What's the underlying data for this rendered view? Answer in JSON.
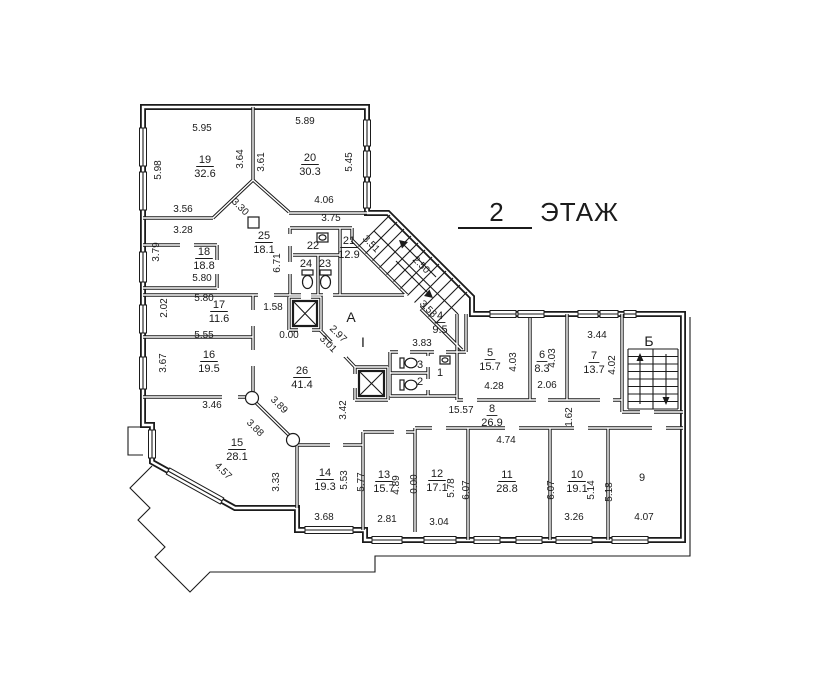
{
  "title": {
    "floor_number": "2",
    "floor_word": "ЭТАЖ"
  },
  "plan": {
    "rooms": [
      {
        "n": "19",
        "a": "32.6",
        "x": 205,
        "y": 166
      },
      {
        "n": "20",
        "a": "30.3",
        "x": 310,
        "y": 164
      },
      {
        "n": "25",
        "a": "18.1",
        "x": 264,
        "y": 242
      },
      {
        "n": "18",
        "a": "18.8",
        "x": 204,
        "y": 258
      },
      {
        "n": "17",
        "a": "11.6",
        "x": 219,
        "y": 311
      },
      {
        "n": "16",
        "a": "19.5",
        "x": 209,
        "y": 361
      },
      {
        "n": "15",
        "a": "28.1",
        "x": 237,
        "y": 449
      },
      {
        "n": "26",
        "a": "41.4",
        "x": 302,
        "y": 377
      },
      {
        "n": "21",
        "a": "12.9",
        "x": 349,
        "y": 247
      },
      {
        "n": "22",
        "a": "",
        "x": 313,
        "y": 245
      },
      {
        "n": "24",
        "a": "",
        "x": 306,
        "y": 263
      },
      {
        "n": "23",
        "a": "",
        "x": 325,
        "y": 263
      },
      {
        "n": "4",
        "a": "9.5",
        "x": 440,
        "y": 322
      },
      {
        "n": "3",
        "a": "",
        "x": 420,
        "y": 364
      },
      {
        "n": "2",
        "a": "",
        "x": 420,
        "y": 381
      },
      {
        "n": "1",
        "a": "",
        "x": 440,
        "y": 372
      },
      {
        "n": "5",
        "a": "15.7",
        "x": 490,
        "y": 359
      },
      {
        "n": "6",
        "a": "8.3",
        "x": 542,
        "y": 361
      },
      {
        "n": "7",
        "a": "13.7",
        "x": 594,
        "y": 362
      },
      {
        "n": "8",
        "a": "26.9",
        "x": 492,
        "y": 415
      },
      {
        "n": "9",
        "a": "",
        "x": 642,
        "y": 477
      },
      {
        "n": "10",
        "a": "19.1",
        "x": 577,
        "y": 481
      },
      {
        "n": "11",
        "a": "28.8",
        "x": 507,
        "y": 481
      },
      {
        "n": "12",
        "a": "17.1",
        "x": 437,
        "y": 480
      },
      {
        "n": "13",
        "a": "15.7",
        "x": 384,
        "y": 481
      },
      {
        "n": "14",
        "a": "19.3",
        "x": 325,
        "y": 479
      }
    ],
    "dims": [
      {
        "t": "5.95",
        "x": 202,
        "y": 131,
        "r": 0
      },
      {
        "t": "5.98",
        "x": 161,
        "y": 170,
        "r": -90
      },
      {
        "t": "3.64",
        "x": 243,
        "y": 159,
        "r": -90
      },
      {
        "t": "3.61",
        "x": 264,
        "y": 162,
        "r": -90
      },
      {
        "t": "5.89",
        "x": 305,
        "y": 124,
        "r": 0
      },
      {
        "t": "5.45",
        "x": 352,
        "y": 162,
        "r": -90
      },
      {
        "t": "4.06",
        "x": 324,
        "y": 203,
        "r": 0
      },
      {
        "t": "3.75",
        "x": 331,
        "y": 221,
        "r": 0
      },
      {
        "t": "3.56",
        "x": 183,
        "y": 212,
        "r": 0
      },
      {
        "t": "3.28",
        "x": 183,
        "y": 233,
        "r": 0
      },
      {
        "t": "3.30",
        "x": 238,
        "y": 209,
        "r": 45
      },
      {
        "t": "3.79",
        "x": 159,
        "y": 252,
        "r": -90
      },
      {
        "t": "5.80",
        "x": 202,
        "y": 281,
        "r": 0
      },
      {
        "t": "5.80",
        "x": 204,
        "y": 301,
        "r": 0
      },
      {
        "t": "2.02",
        "x": 167,
        "y": 308,
        "r": -90
      },
      {
        "t": "1.58",
        "x": 273,
        "y": 310,
        "r": 0
      },
      {
        "t": "0.00",
        "x": 289,
        "y": 338,
        "r": 0
      },
      {
        "t": "5.55",
        "x": 204,
        "y": 338,
        "r": 0
      },
      {
        "t": "3.67",
        "x": 166,
        "y": 363,
        "r": -90
      },
      {
        "t": "2.97",
        "x": 336,
        "y": 336,
        "r": 45
      },
      {
        "t": "3.01",
        "x": 326,
        "y": 346,
        "r": 45
      },
      {
        "t": "2.50",
        "x": 419,
        "y": 267,
        "r": 45
      },
      {
        "t": "3.58",
        "x": 426,
        "y": 311,
        "r": 45
      },
      {
        "t": "3.51",
        "x": 369,
        "y": 246,
        "r": 45
      },
      {
        "t": "6.71",
        "x": 280,
        "y": 263,
        "r": -90
      },
      {
        "t": "4.28",
        "x": 494,
        "y": 389,
        "r": 0
      },
      {
        "t": "4.03",
        "x": 516,
        "y": 362,
        "r": -90
      },
      {
        "t": "2.06",
        "x": 547,
        "y": 388,
        "r": 0
      },
      {
        "t": "4.03",
        "x": 555,
        "y": 358,
        "r": -90
      },
      {
        "t": "3.44",
        "x": 597,
        "y": 338,
        "r": 0
      },
      {
        "t": "4.02",
        "x": 615,
        "y": 365,
        "r": -90
      },
      {
        "t": "15.57",
        "x": 461,
        "y": 413,
        "r": 0
      },
      {
        "t": "1.62",
        "x": 572,
        "y": 417,
        "r": -90
      },
      {
        "t": "3.42",
        "x": 346,
        "y": 410,
        "r": -90
      },
      {
        "t": "3.46",
        "x": 212,
        "y": 408,
        "r": 0
      },
      {
        "t": "3.89",
        "x": 277,
        "y": 407,
        "r": 45
      },
      {
        "t": "3.88",
        "x": 253,
        "y": 430,
        "r": 45
      },
      {
        "t": "4.57",
        "x": 221,
        "y": 473,
        "r": 45
      },
      {
        "t": "3.33",
        "x": 279,
        "y": 482,
        "r": -90
      },
      {
        "t": "3.83",
        "x": 422,
        "y": 346,
        "r": 0
      },
      {
        "t": "5.53",
        "x": 347,
        "y": 480,
        "r": -90
      },
      {
        "t": "3.68",
        "x": 324,
        "y": 520,
        "r": 0
      },
      {
        "t": "5.77",
        "x": 364,
        "y": 482,
        "r": -90
      },
      {
        "t": "4.89",
        "x": 399,
        "y": 485,
        "r": -90
      },
      {
        "t": "2.81",
        "x": 387,
        "y": 522,
        "r": 0
      },
      {
        "t": "0.00",
        "x": 417,
        "y": 484,
        "r": -90
      },
      {
        "t": "5.78",
        "x": 454,
        "y": 488,
        "r": -90
      },
      {
        "t": "3.04",
        "x": 439,
        "y": 525,
        "r": 0
      },
      {
        "t": "6.07",
        "x": 469,
        "y": 490,
        "r": -90
      },
      {
        "t": "4.74",
        "x": 506,
        "y": 443,
        "r": 0
      },
      {
        "t": "6.07",
        "x": 554,
        "y": 490,
        "r": -90
      },
      {
        "t": "5.14",
        "x": 594,
        "y": 490,
        "r": -90
      },
      {
        "t": "3.26",
        "x": 574,
        "y": 520,
        "r": 0
      },
      {
        "t": "5.18",
        "x": 612,
        "y": 492,
        "r": -90
      },
      {
        "t": "4.07",
        "x": 644,
        "y": 520,
        "r": 0
      }
    ],
    "marks": [
      {
        "t": "А",
        "x": 351,
        "y": 322,
        "s": 14
      },
      {
        "t": "Б",
        "x": 649,
        "y": 346,
        "s": 14
      },
      {
        "t": "I",
        "x": 363,
        "y": 347,
        "s": 11
      }
    ]
  }
}
